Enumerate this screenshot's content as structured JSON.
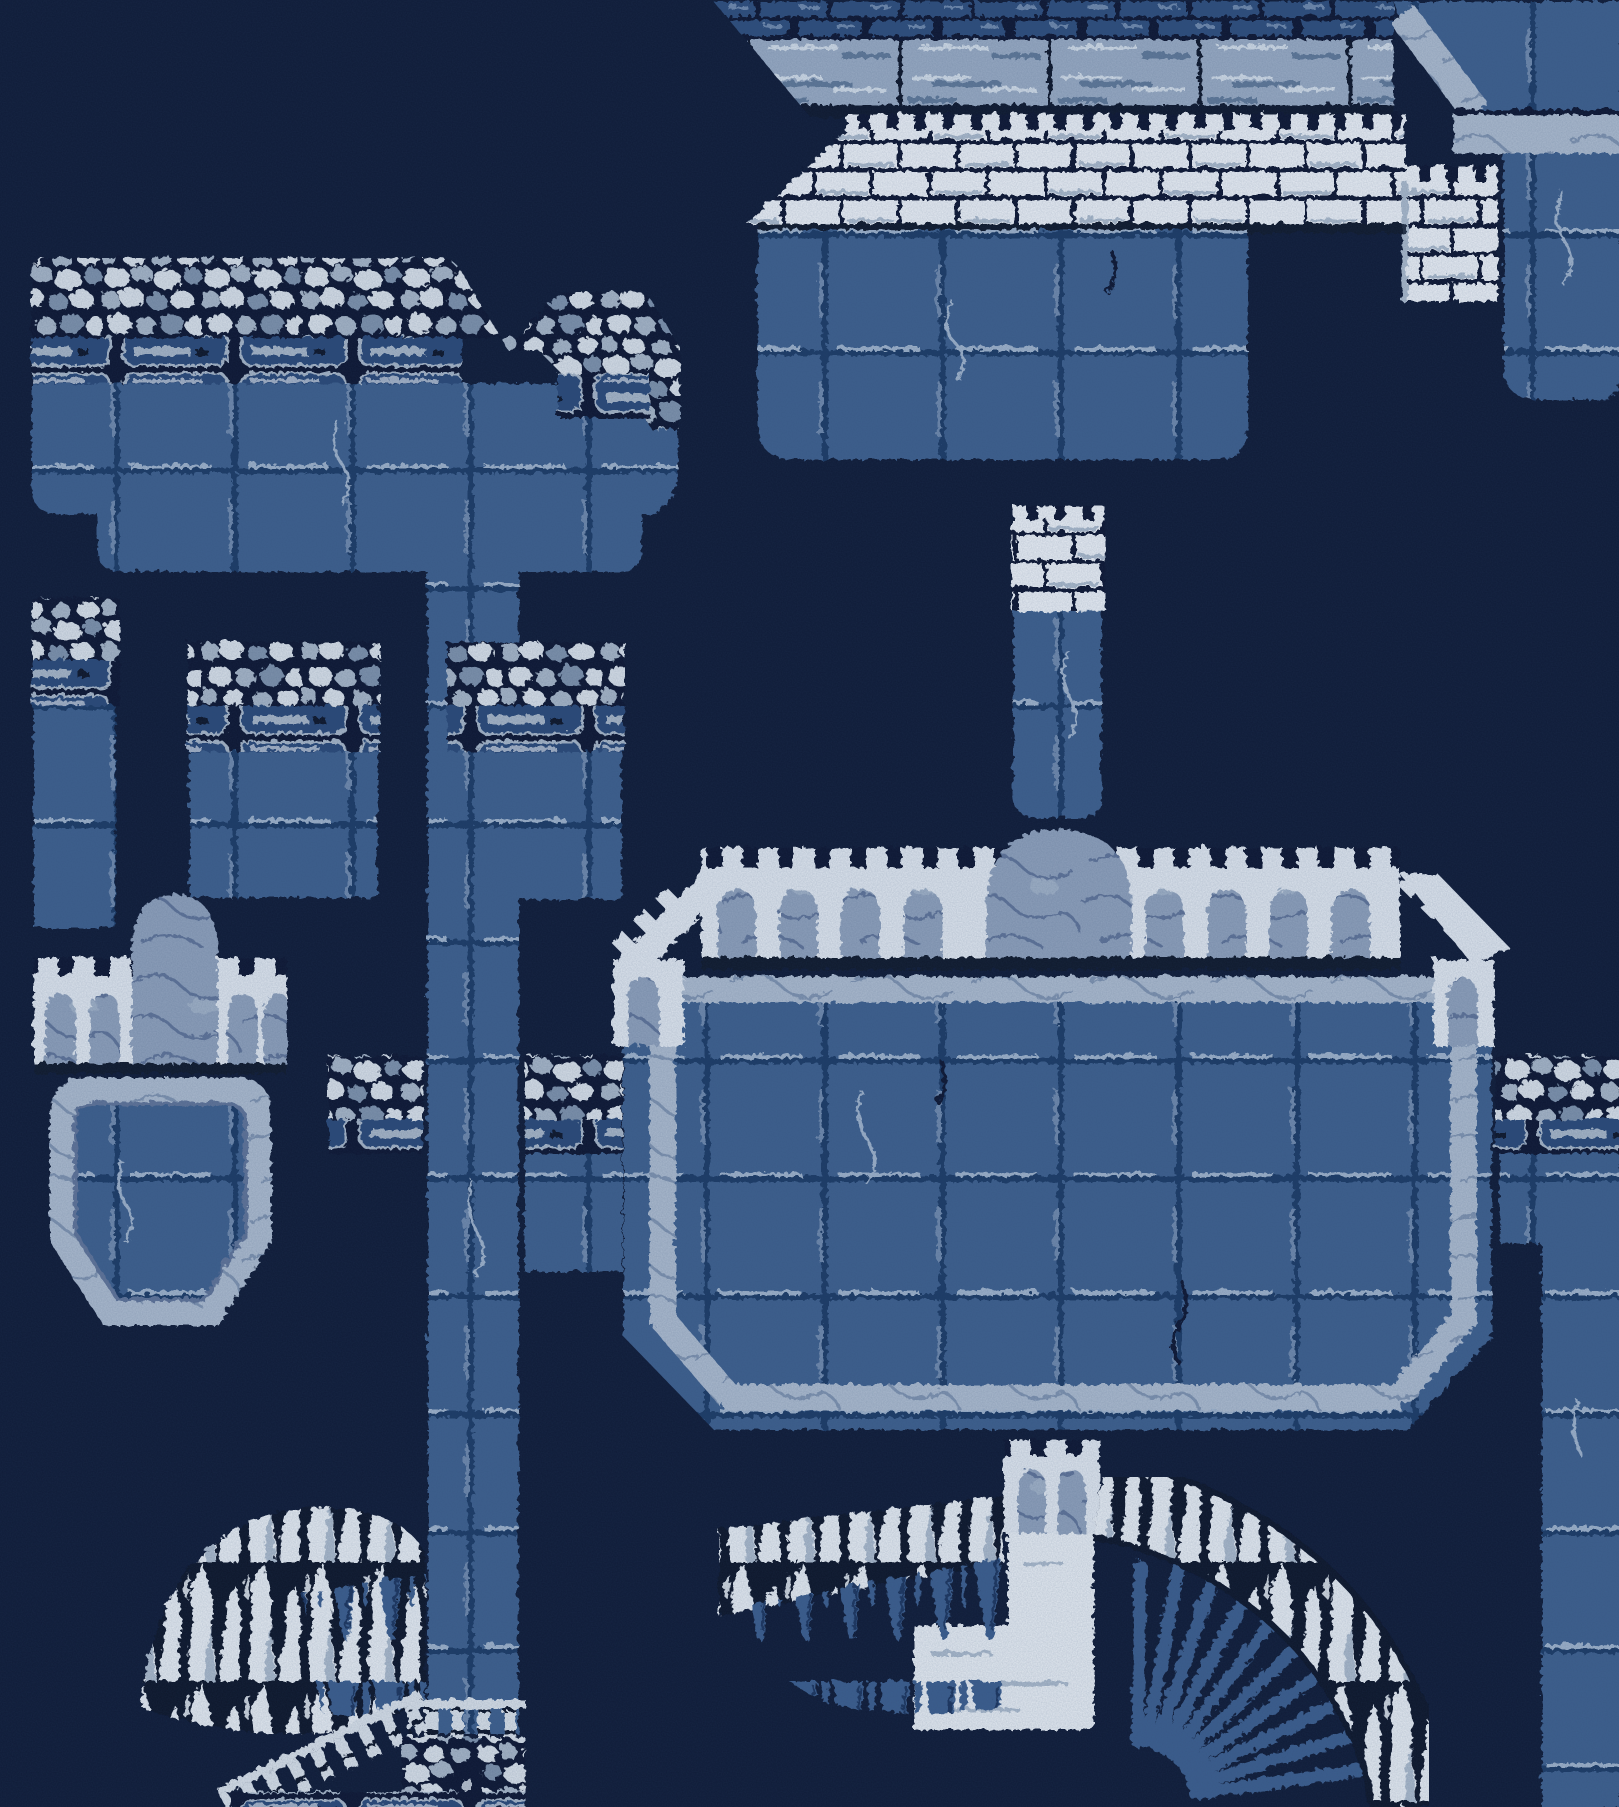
{
  "scene": {
    "title": "Castle dungeon level map - blue night pixel art",
    "type": "game-level-map",
    "style": "dithered 8-bit pixel art, monochrome indigo palette",
    "visible_text": "none"
  },
  "palette": {
    "bg": "#0f1b37",
    "tile": "#3d5e8d",
    "tileDark": "#1f3a66",
    "tileLine": "#9db1ca",
    "tileSoft": "#6e88ac",
    "brickTop": "#2d4d7c",
    "white": "#e7ecf3",
    "whiteShade": "#a9b8ca",
    "mortar": "#0b1731",
    "plank": "#97a9c2",
    "plankLight": "#cfdae6",
    "plankDark": "#5f7898",
    "cobbleLight": "#d6dee7",
    "cobbleMid": "#a5b4c6",
    "cobbleDim": "#7d91ab",
    "lintelFace": "#2c4a78",
    "marble": "#8d9fba",
    "marbleLine": "#5e7398",
    "marbleLight": "#aab9cd",
    "marbleLightLine": "#7e92af",
    "arcade": "#dde4ed",
    "arcadeShadow": "#9fb0c4",
    "drape": "#3b5d8d",
    "drapeDark": "#1c355e",
    "shadow": "#0a142c",
    "flame": "#e3e9f0"
  },
  "structures": [
    {
      "id": "top-bridge",
      "label": "plank walkway bridge, top"
    },
    {
      "id": "ceiling-block",
      "label": "tiled ceiling block with marble ledge, top right"
    },
    {
      "id": "right-upper-wall",
      "label": "tiled wall below ledge, upper right"
    },
    {
      "id": "castle-rampart",
      "label": "white brick rampart with crenellations"
    },
    {
      "id": "castle-platform",
      "label": "tiled platform body under rampart"
    },
    {
      "id": "hanging-pillar",
      "label": "hanging pillar with white brick capital"
    },
    {
      "id": "left-platform",
      "label": "cobble-capped platform, upper left"
    },
    {
      "id": "left-column",
      "label": "cobble-capped narrow column, left edge"
    },
    {
      "id": "mid-platform",
      "label": "cobble-capped platform, middle left"
    },
    {
      "id": "cap-column",
      "label": "cobble-capped column, centre left"
    },
    {
      "id": "tall-column",
      "label": "tall tiled column spanning map"
    },
    {
      "id": "left-walkway",
      "label": "cobble walkway west of fortress"
    },
    {
      "id": "right-walkway",
      "label": "cobble walkway east of fortress"
    },
    {
      "id": "right-wall",
      "label": "tiled wall, lower right edge"
    },
    {
      "id": "arched-fort",
      "label": "crenellated arcade fort with marble tower, left"
    },
    {
      "id": "shield-panel",
      "label": "shield-shaped tiled panel with marble frame"
    },
    {
      "id": "central-fortress",
      "label": "great octagonal fortress with arcade parapet"
    },
    {
      "id": "fortress-tower",
      "label": "round-topped marble tower on fortress"
    },
    {
      "id": "fall-tower",
      "label": "small crenellated tower over waterfall"
    },
    {
      "id": "waterfall",
      "label": "white waterfall column"
    },
    {
      "id": "flame-ridge-left",
      "label": "white flame ridge, lower left"
    },
    {
      "id": "flame-ridge-center",
      "label": "white flame ridge left of waterfall"
    },
    {
      "id": "flame-curve-right",
      "label": "curved flame ridge with fan vault, lower right"
    },
    {
      "id": "staircase-balustrade",
      "label": "descending staircase balustrade"
    },
    {
      "id": "cobble-wall",
      "label": "cobblestone wall with statue niche, bottom"
    }
  ]
}
